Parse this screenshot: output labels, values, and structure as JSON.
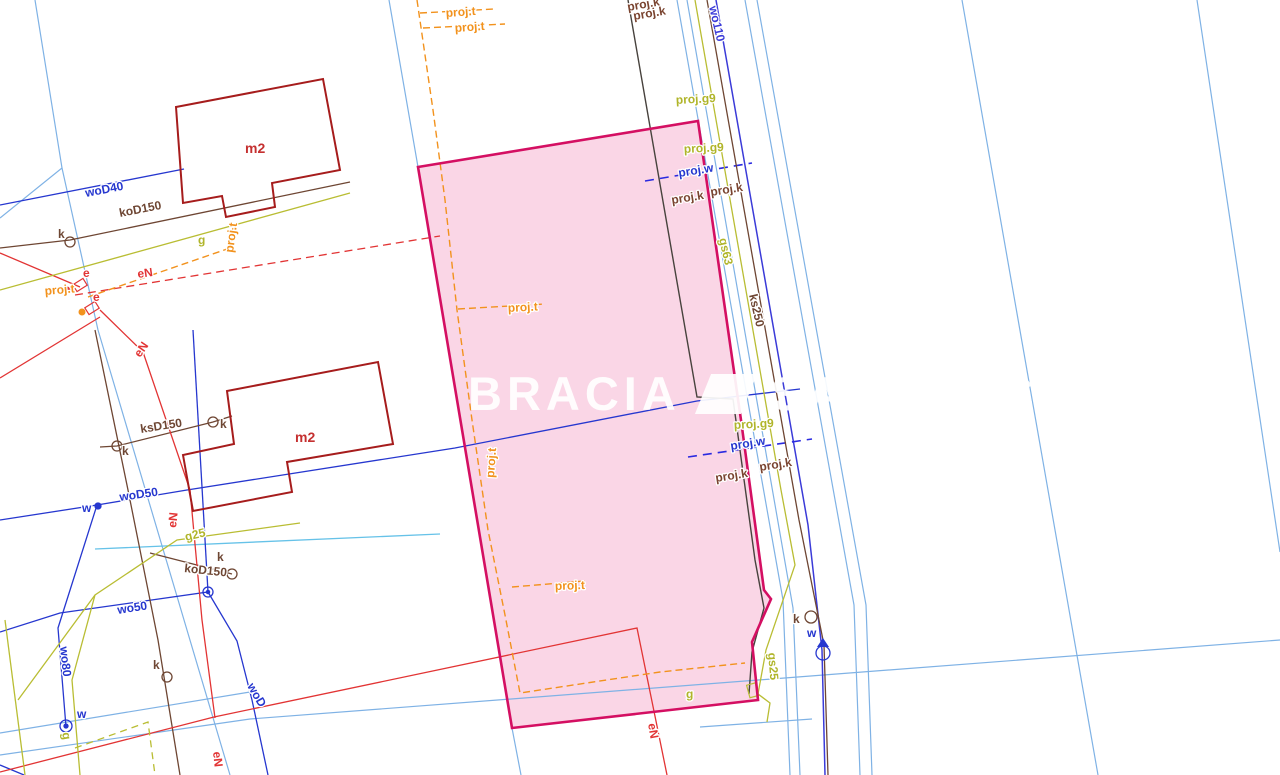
{
  "watermark": {
    "left": "BRACIA",
    "right": "SADURSCY"
  },
  "labels": {
    "m2": "m2",
    "proj_t": "proj.t",
    "proj_w": "proj.w",
    "proj_k": "proj.k",
    "proj_g": "proj.g9",
    "wo110": "wo110",
    "gs63": "gs63",
    "ks250": "ks250",
    "gs25": "gs25",
    "woD40": "woD40",
    "koD150": "koD150",
    "ksD150": "ksD150",
    "woD50": "woD50",
    "wo50": "wo50",
    "wo80": "wo80",
    "woD": "woD",
    "g": "g",
    "g25": "g25",
    "eN": "eN",
    "e": "e",
    "k": "k",
    "w": "w"
  },
  "colors": {
    "parcel_highlight_fill": "#f6aecd",
    "parcel_highlight_border": "#d40f62",
    "cadastral_line": "#7fb2e5",
    "water_line": "#2637cf",
    "water_main_wo110": "#3b3bd8",
    "sewer_line": "#6e4633",
    "gas_line": "#b9bd33",
    "power_line": "#e23434",
    "planned_telecom": "#f2921d",
    "building_outline": "#a61c1c",
    "watermark_color": "#ffffff"
  }
}
